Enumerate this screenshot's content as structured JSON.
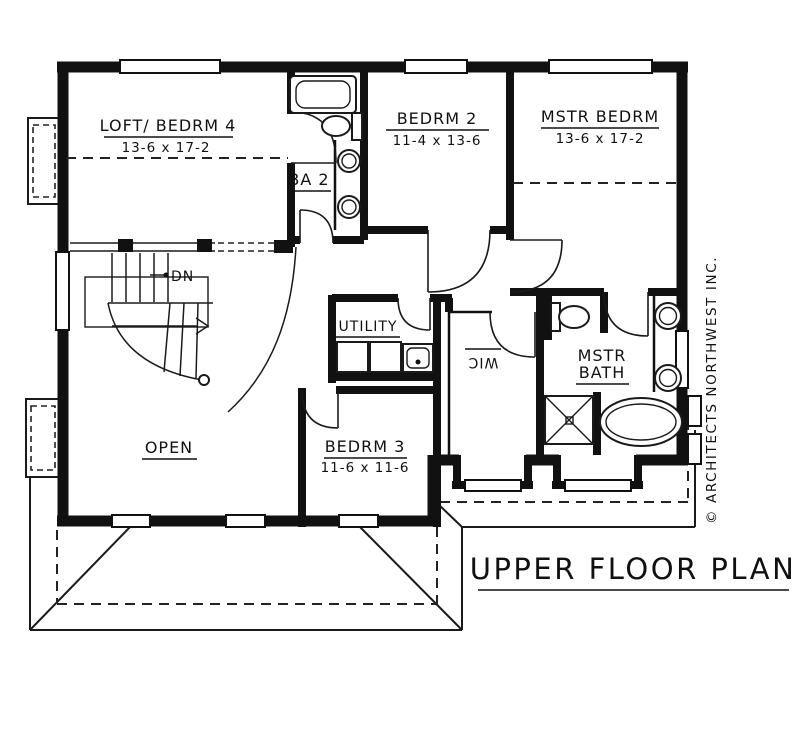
{
  "title": {
    "text": "UPPER FLOOR PLAN"
  },
  "copyright": {
    "text": "© ARCHITECTS NORTHWEST INC."
  },
  "colors": {
    "line": "#111111",
    "background": "#ffffff"
  },
  "rooms": {
    "loft_bedrm4": {
      "name": "LOFT/ BEDRM 4",
      "dims": "13-6 x 17-2"
    },
    "bedrm2": {
      "name": "BEDRM 2",
      "dims": "11-4 x 13-6"
    },
    "mstr_bedrm": {
      "name": "MSTR BEDRM",
      "dims": "13-6 x 17-2"
    },
    "ba2": {
      "name": "BA 2"
    },
    "utility": {
      "name": "UTILITY"
    },
    "wic": {
      "name": "WIC"
    },
    "mstr_bath": {
      "name_line1": "MSTR",
      "name_line2": "BATH"
    },
    "bedrm3": {
      "name": "BEDRM 3",
      "dims": "11-6 x 11-6"
    },
    "open": {
      "name": "OPEN"
    }
  },
  "annotations": {
    "stairs_down": "DN"
  },
  "fixtures": [
    "bathtub-icon",
    "toilet-icon",
    "sink-icon",
    "sink-icon",
    "washer-icon",
    "dryer-icon",
    "laundry-sink-icon",
    "toilet-icon",
    "sink-icon",
    "sink-icon",
    "shower-icon",
    "garden-tub-icon"
  ]
}
